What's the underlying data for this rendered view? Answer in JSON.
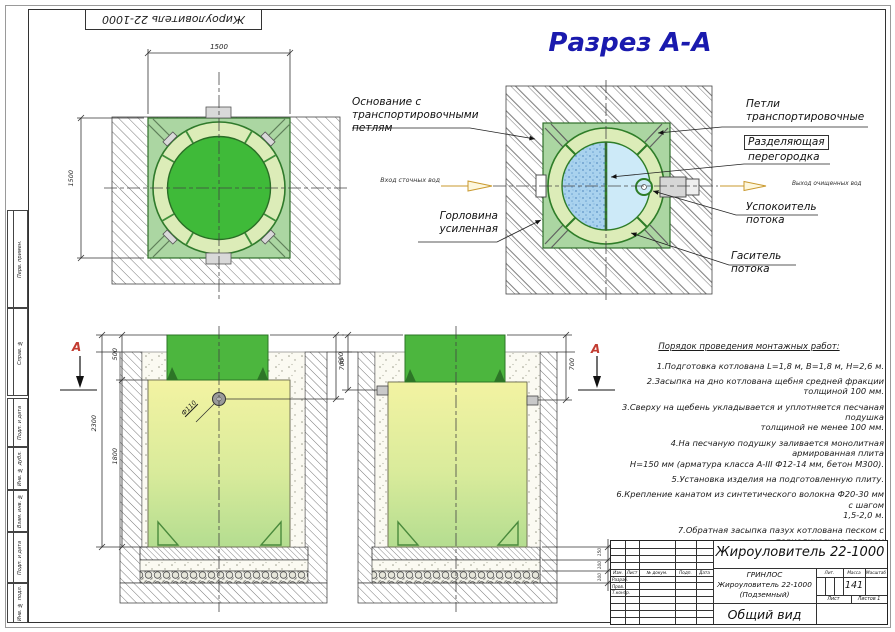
{
  "frame": {
    "top_stamp": "Жироуловитель 22-1000",
    "margin_labels": [
      "Перв. примен.",
      "Справ. №",
      "Подп. и дата",
      "Инв. № дубл.",
      "Взам. инв. №",
      "Подп. и дата",
      "Инв. № подл."
    ]
  },
  "plan": {
    "dim_w": "1500",
    "dim_h": "1500"
  },
  "section": {
    "title": "Разрез А-А",
    "inlet": "Вход сточных вод",
    "outlet": "Выход очищенных вод",
    "callouts": {
      "base": "Основание с\nтранспортировочными\nпетлям",
      "neck": "Горловина\nусиленная",
      "loops": "Петли\nтранспортировочные",
      "divider_line1": "Разделяющая",
      "divider_line2": "перегородка",
      "calm": "Успокоитель\nпотока",
      "damper": "Гаситель\nпотока"
    }
  },
  "front": {
    "marker": "А",
    "dim_neck": "500",
    "dim_total": "2300",
    "dim_body": "1800",
    "dim_depth": "700",
    "dim_pipe": "Ф110"
  },
  "side": {
    "marker": "А",
    "dim_left": "600",
    "dim_right": "700",
    "layer_dims": [
      "150",
      "100",
      "100"
    ]
  },
  "instructions": {
    "title": "Порядок проведения монтажных работ:",
    "items": [
      "1.Подготовка котлована L=1,8 м, В=1,8 м, Н=2,6 м.",
      "2.Засыпка на дно котлована щебня средней фракции толщиной 100 мм.",
      "3.Сверху на щебень укладывается и уплотняется песчаная подушка\nтолщиной не менее 100 мм.",
      "4.На песчаную подушку заливается монолитная армированная плита\nН=150 мм (арматура класса А-III Ф12-14 мм, бетон М300).",
      "5.Установка изделия на подготовленную плиту.",
      "6.Крепление канатом из синтетического волокна Ф20-30 мм с шагом\n1,5-2,0 м.",
      "7.Обратная засыпка пазух котлована песком с периодическим поливом\nводой и его уплотнением, а также с одновременной заливкой водой\nвнутрь изделия."
    ]
  },
  "title_block": {
    "product": "Жироуловитель 22-1000",
    "org": "ГРИНЛОС",
    "doc_line1": "Жироуловитель 22-1000",
    "doc_line2": "(Подземный)",
    "view": "Общий вид",
    "columns": [
      "Изм.",
      "Лист",
      "№ докум.",
      "Подп.",
      "Дата"
    ],
    "sign_rows": [
      "Разраб.",
      "Пров.",
      "Т.контр."
    ],
    "lit_header": "Лит.",
    "mass_header": "Масса",
    "scale_header": "Масштаб",
    "mass_value": "141",
    "sheet_label": "Лист",
    "sheets_label": "Листов 1"
  },
  "colors": {
    "accent_blue": "#1a1aae",
    "marker_red": "#c23b30",
    "flow_yellow": "#c9992e",
    "tank_green": "#4cb63e",
    "plate_green": "#abd6a2",
    "water_blue": "#a9d2ee"
  }
}
